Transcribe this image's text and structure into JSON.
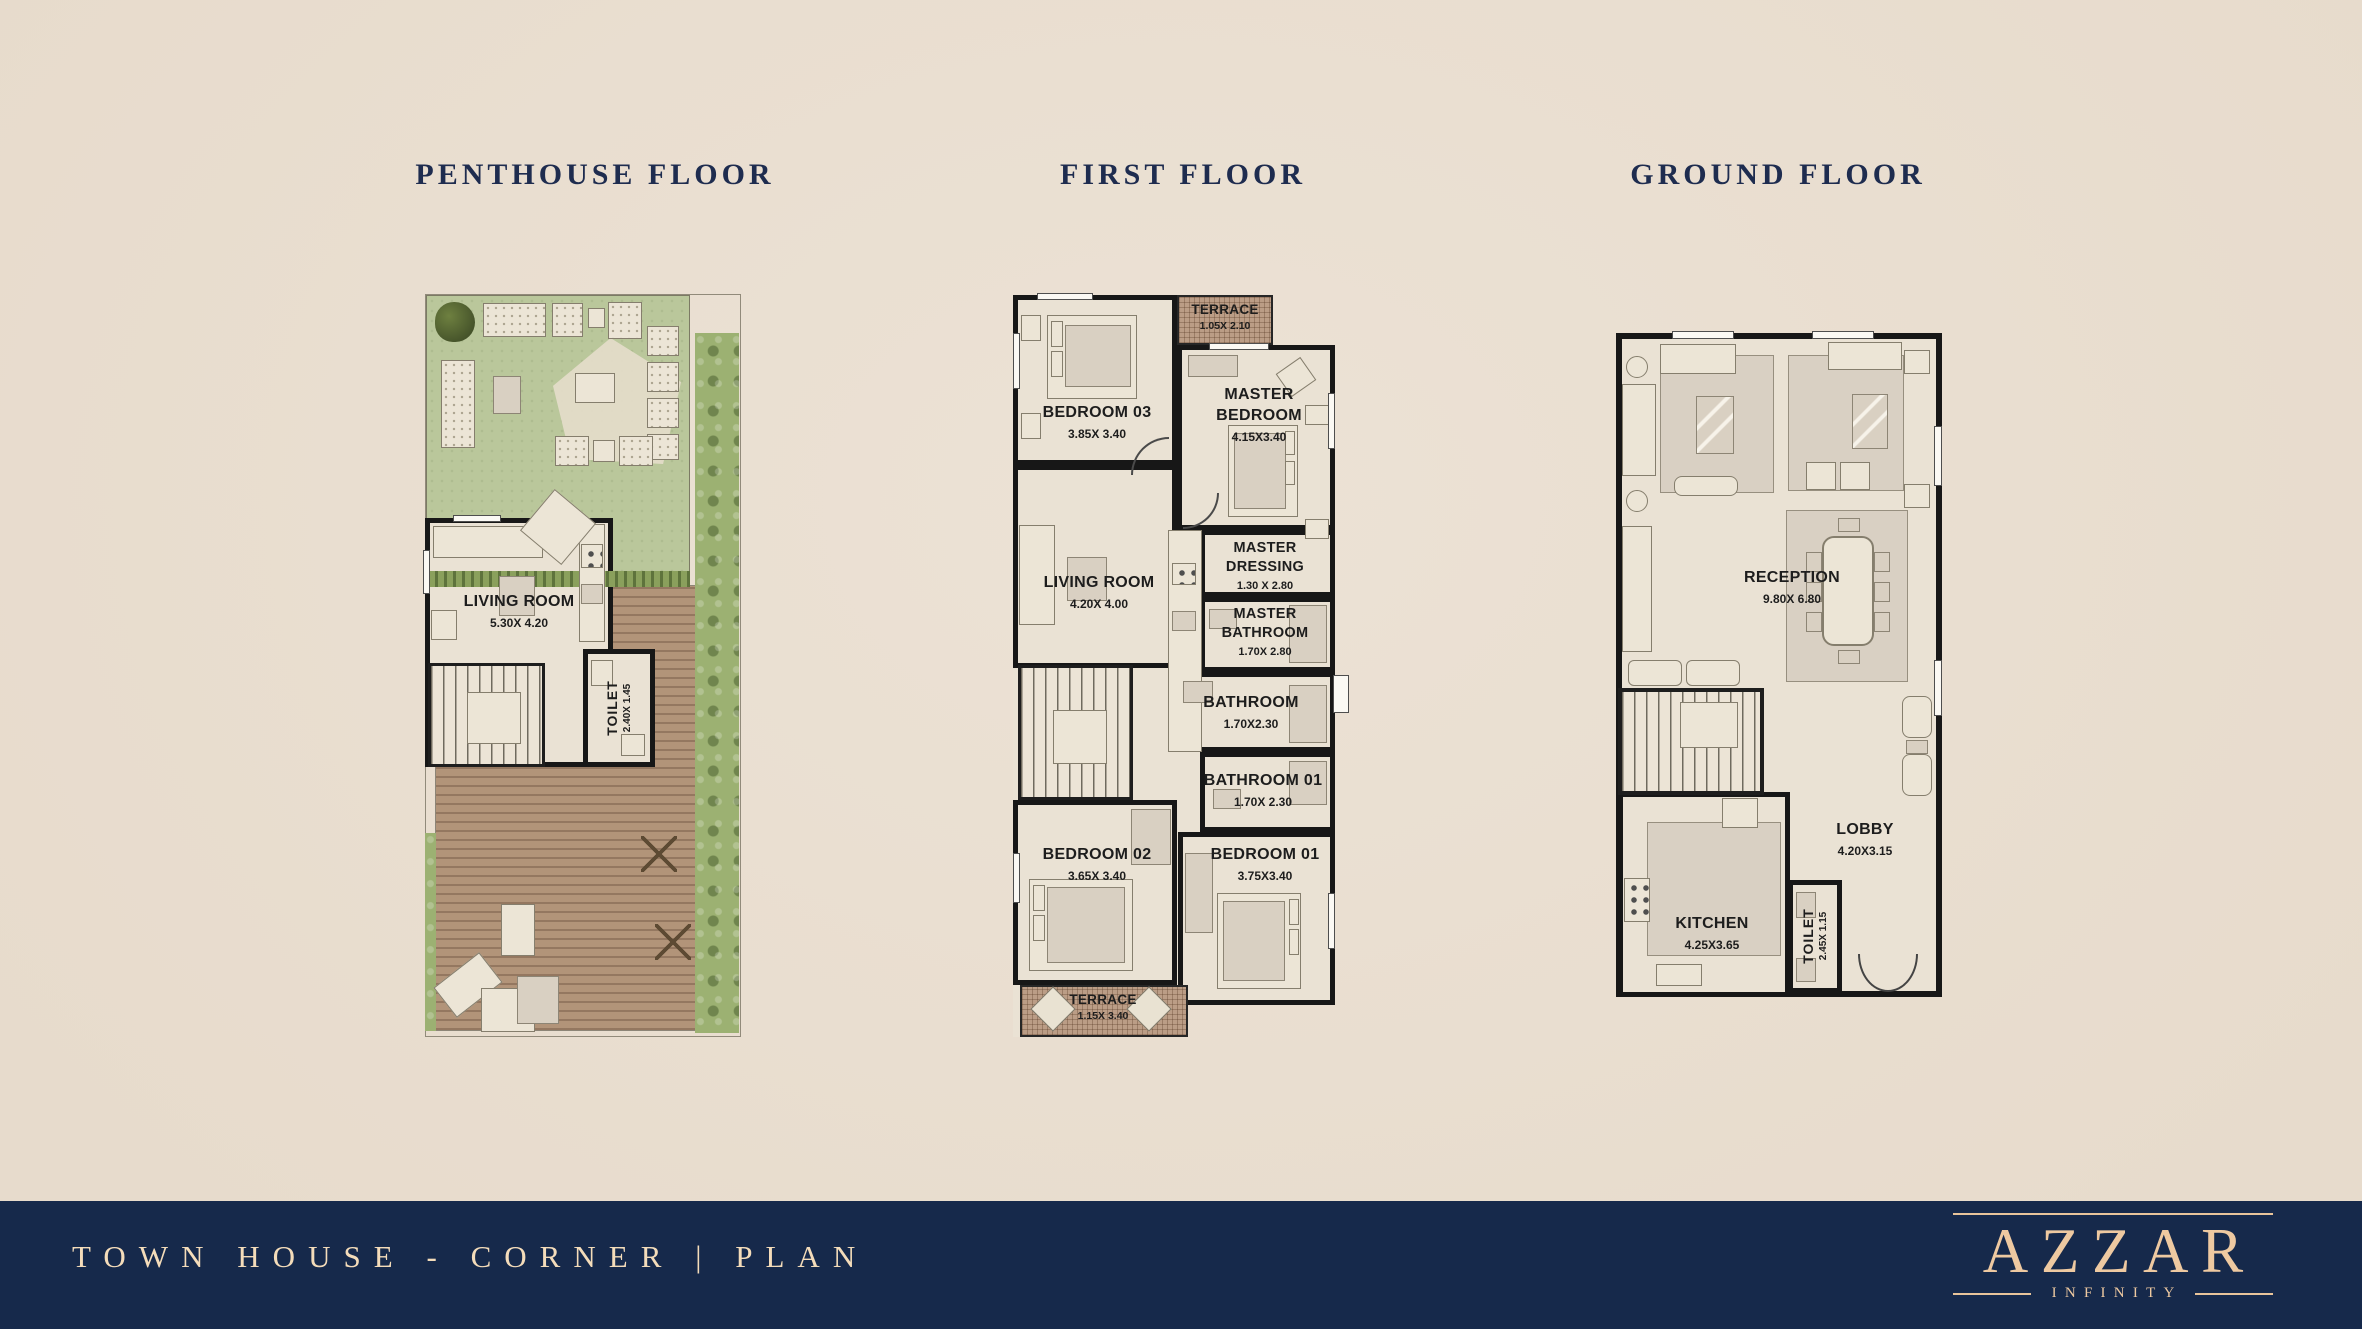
{
  "titles": {
    "penthouse": "PENTHOUSE FLOOR",
    "first": "FIRST FLOOR",
    "ground": "GROUND FLOOR"
  },
  "penthouse": {
    "living_room": {
      "label": "LIVING ROOM",
      "dims": "5.30X 4.20"
    },
    "toilet": {
      "label": "TOILET",
      "dims": "2.40X 1.45"
    }
  },
  "first_floor": {
    "terrace_top": {
      "label": "TERRACE",
      "dims": "1.05X 2.10"
    },
    "bedroom03": {
      "label": "BEDROOM 03",
      "dims": "3.85X 3.40"
    },
    "master_bedroom": {
      "line1": "MASTER",
      "line2": "BEDROOM",
      "dims": "4.15X3.40"
    },
    "living_room": {
      "label": "LIVING ROOM",
      "dims": "4.20X 4.00"
    },
    "master_dressing": {
      "line1": "MASTER",
      "line2": "DRESSING",
      "dims": "1.30 X 2.80"
    },
    "master_bathroom": {
      "line1": "MASTER",
      "line2": "BATHROOM",
      "dims": "1.70X 2.80"
    },
    "bathroom": {
      "label": "BATHROOM",
      "dims": "1.70X2.30"
    },
    "bathroom01": {
      "label": "BATHROOM 01",
      "dims": "1.70X 2.30"
    },
    "bedroom02": {
      "label": "BEDROOM 02",
      "dims": "3.65X 3.40"
    },
    "bedroom01": {
      "label": "BEDROOM 01",
      "dims": "3.75X3.40"
    },
    "terrace_bottom": {
      "label": "TERRACE",
      "dims": "1.15X 3.40"
    }
  },
  "ground_floor": {
    "reception": {
      "label": "RECEPTION",
      "dims": "9.80X 6.80"
    },
    "lobby": {
      "label": "LOBBY",
      "dims": "4.20X3.15"
    },
    "kitchen": {
      "label": "KITCHEN",
      "dims": "4.25X3.65"
    },
    "toilet": {
      "label": "TOILET",
      "dims": "2.45X 1.15"
    }
  },
  "footer": {
    "plan_title": "TOWN HOUSE - CORNER | PLAN",
    "brand": "AZZAR",
    "brand_sub": "INFINITY"
  },
  "colors": {
    "background": "#eadfd2",
    "bar": "#16294b",
    "brand_text": "#eec9a1",
    "title_text": "#1e2c4f",
    "wall": "#171717",
    "garden_green": "#bac79b",
    "deck_wood": "#b29479",
    "terrace_hatch": "#bb9d86"
  }
}
